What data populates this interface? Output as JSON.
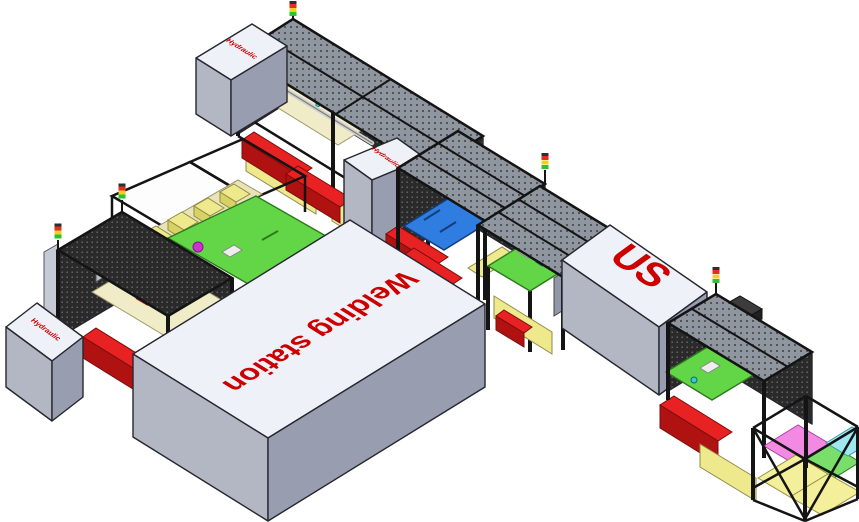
{
  "scene": {
    "background": "#ffffff",
    "labels": {
      "welding_station": "Welding station",
      "us_station": "US",
      "hydraulic_top": "Hydraulic",
      "hydraulic_left": "Hydraulic",
      "hydraulic_mid": "Hydraulic"
    },
    "label_color": "#cc0000",
    "colors": {
      "box_top": "#eef1f7",
      "box_side_left": "#b3b7c4",
      "box_side_right": "#999db0",
      "cage_frame": "#141414",
      "mesh_wall": "#2a2a2a",
      "mesh_roof": "#9096a0",
      "bin_red": "#e82222",
      "bin_red_dark": "#b01212",
      "table_green": "#63d648",
      "plate_blue": "#2f7de0",
      "part_magenta": "#cf2fd4",
      "part_cyan": "#3cc8cc",
      "skirt_yellow": "#eee98c",
      "skirt_olive": "#b0ab62",
      "table_cream": "#f0ecc8",
      "shelf_pink": "#f28ae4",
      "shelf_green": "#7ade6a",
      "shelf_cyan": "#9fe8f0",
      "shelf_yellow": "#f3ef9a",
      "andon_red": "#e03020",
      "andon_yellow": "#f0d020",
      "andon_green": "#30c030"
    }
  }
}
